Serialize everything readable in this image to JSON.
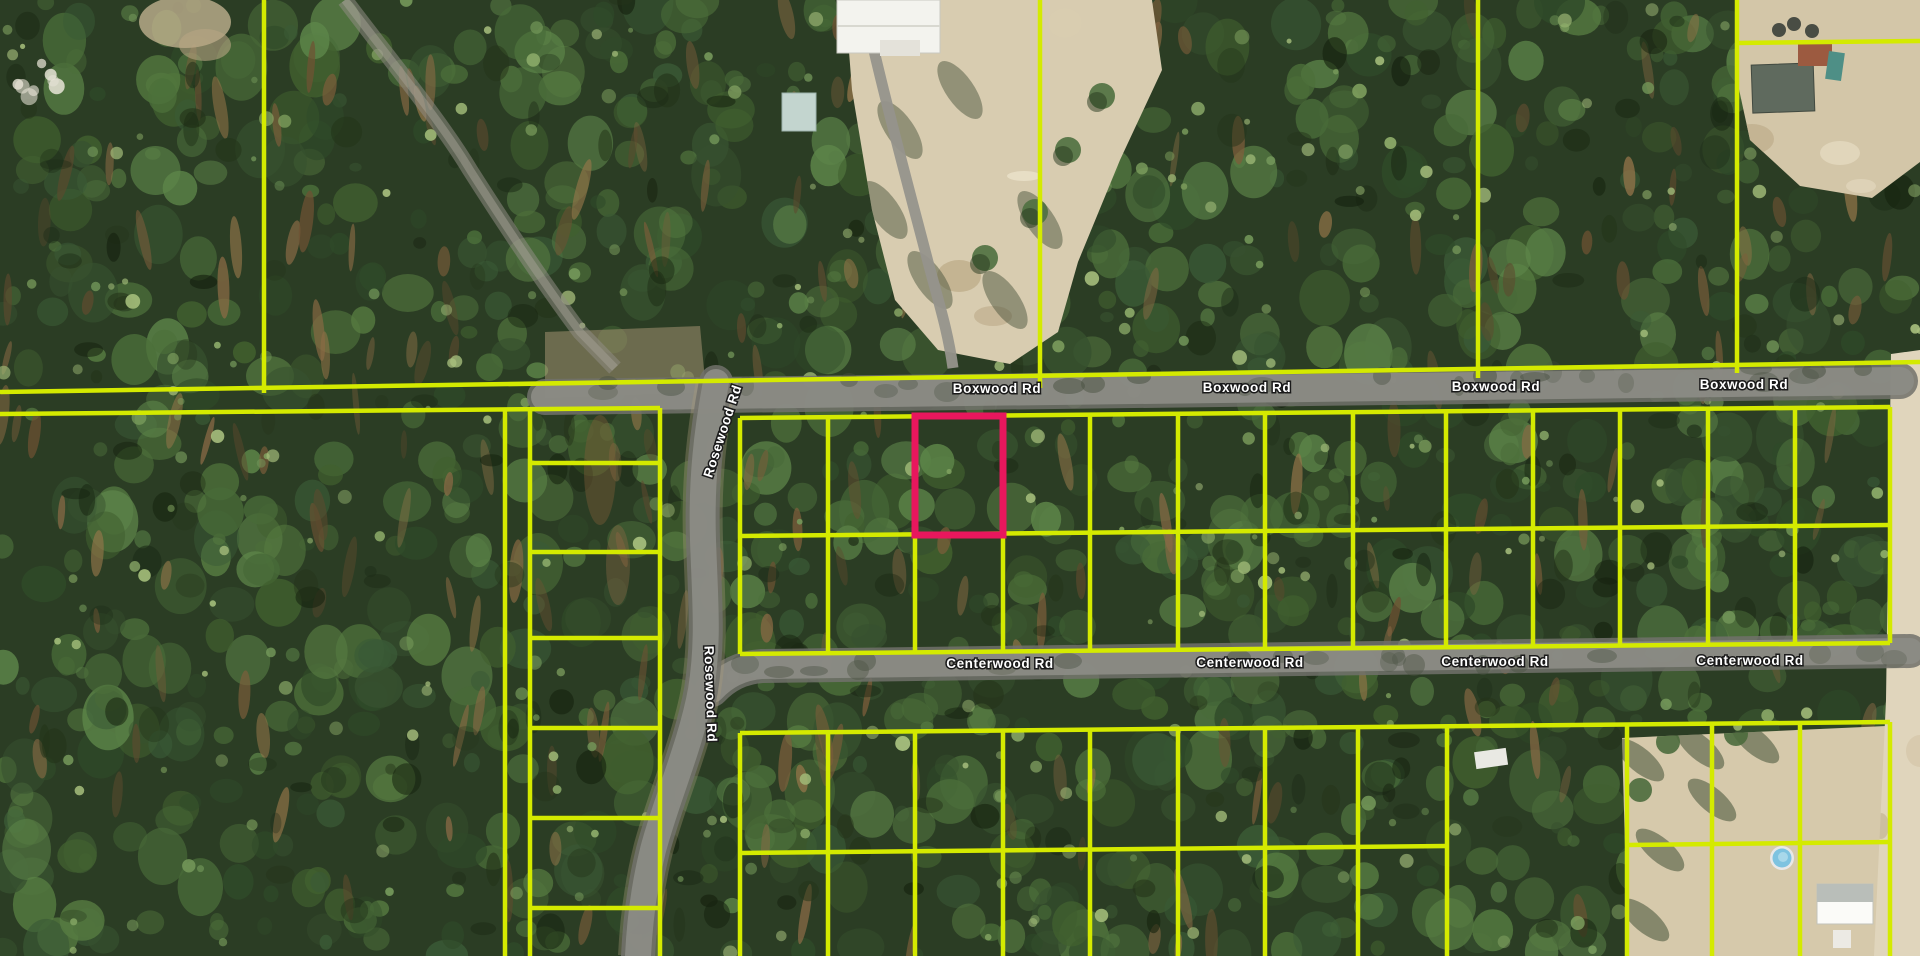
{
  "map": {
    "kind": "aerial-parcel-map",
    "roads": {
      "boxwood": {
        "label": "Boxwood Rd",
        "label_count": 4
      },
      "centerwood": {
        "label": "Centerwood Rd",
        "label_count": 4
      },
      "rosewood": {
        "label": "Rosewood Rd",
        "label_count": 2
      }
    },
    "colors": {
      "parcel_line": "#d4ea00",
      "highlight_parcel": "#e8175d",
      "road_fill": "#8c8c85",
      "road_casing": "#71716b",
      "forest_base": "#2b3d24",
      "sand": "#d8ccb0"
    },
    "highlighted_parcel": {
      "present": true,
      "outline": "#e8175d"
    }
  }
}
